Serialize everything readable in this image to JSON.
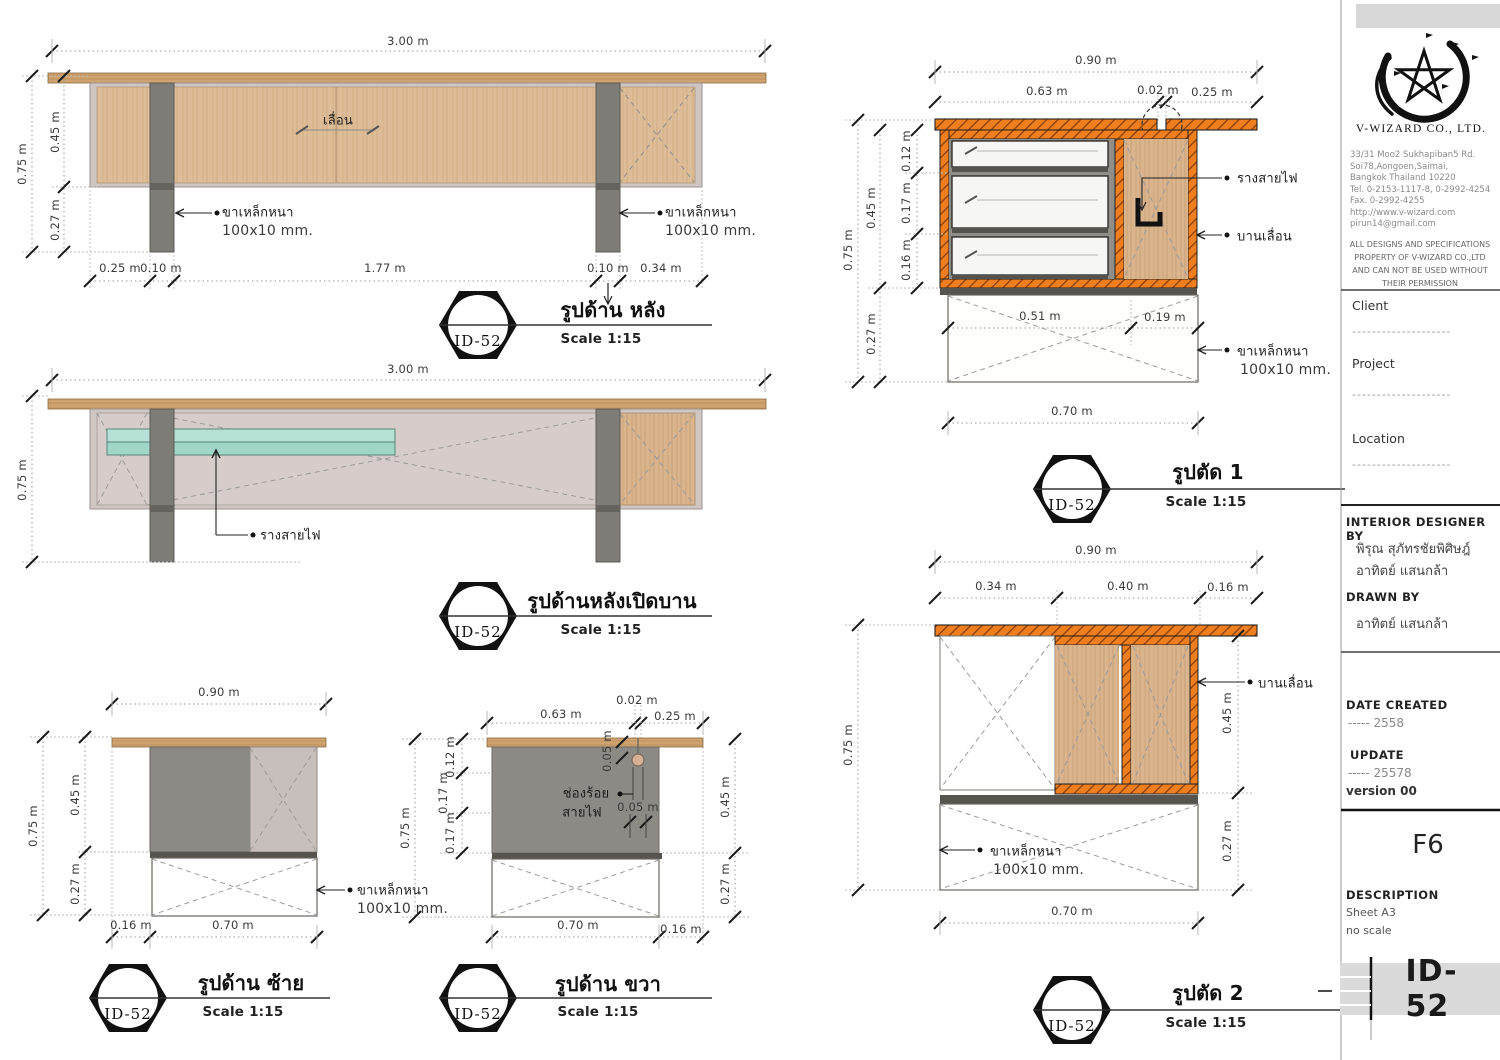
{
  "colors": {
    "section_orange": "#EF7E1F",
    "wood_grain": "#D9B48C",
    "tabletop_wood": "#CFA36F",
    "carcass_gray": "#8B8A84",
    "raceway_teal": "#9FD6C8",
    "leg_gray": "#7D7C77"
  },
  "views": {
    "rear": {
      "badge": "ID-52",
      "title": "รูปด้าน หลัง",
      "scale": "Scale 1:15",
      "dim_top": "3.00 m",
      "dim_left_total": "0.75 m",
      "dim_left_upper": "0.45 m",
      "dim_left_lower": "0.27 m",
      "dims_bottom": [
        "0.25 m",
        "0.10 m",
        "1.77 m",
        "0.10 m",
        "0.34 m"
      ],
      "label_slide": "เลื่อน",
      "leg_note_line1": "ขาเหล็กหนา",
      "leg_note_line2": "100x10 mm."
    },
    "rear_open": {
      "badge": "ID-52",
      "title": "รูปด้านหลังเปิดบาน",
      "scale": "Scale 1:15",
      "dim_top": "3.00 m",
      "dim_left_total": "0.75 m",
      "label_raceway": "รางสายไฟ"
    },
    "left_view": {
      "badge": "ID-52",
      "title": "รูปด้าน ซ้าย",
      "scale": "Scale 1:15",
      "dim_top": "0.90 m",
      "dim_left_total": "0.75 m",
      "dim_left_upper": "0.45 m",
      "dim_left_lower": "0.27 m",
      "dims_bottom": [
        "0.16 m",
        "0.70 m"
      ],
      "leg_note_line1": "ขาเหล็กหนา",
      "leg_note_line2": "100x10 mm."
    },
    "right_view": {
      "badge": "ID-52",
      "title": "รูปด้าน ขวา",
      "scale": "Scale 1:15",
      "dims_top": [
        "0.63 m",
        "0.02 m",
        "0.25 m"
      ],
      "dim_left_total": "0.75 m",
      "dims_left_stack": [
        "0.12 m",
        "0.17 m",
        "0.17 m"
      ],
      "dims_right": [
        "0.45 m",
        "0.27 m"
      ],
      "dims_bottom": [
        "0.70 m",
        "0.16 m"
      ],
      "hole_note_line1": "ช่องร้อย",
      "hole_note_line2": "สายไฟ",
      "dim_hole_top": "0.05 m",
      "dim_hole_side": "0.05 m"
    },
    "section1": {
      "badge": "ID-52",
      "title": "รูปตัด 1",
      "scale": "Scale 1:15",
      "dim_top": "0.90 m",
      "dims_top2": [
        "0.63 m",
        "0.02 m",
        "0.25 m"
      ],
      "dim_left_total": "0.75 m",
      "dim_left_upper": "0.45 m",
      "dim_left_lower": "0.27 m",
      "dims_left_stack": [
        "0.12 m",
        "0.17 m",
        "0.16 m"
      ],
      "dims_inner": [
        "0.51 m",
        "0.19 m"
      ],
      "dim_bottom": "0.70 m",
      "label_raceway": "รางสายไฟ",
      "label_sliding": "บานเลื่อน",
      "leg_note_line1": "ขาเหล็กหนา",
      "leg_note_line2": "100x10 mm."
    },
    "section2": {
      "badge": "ID-52",
      "title": "รูปตัด 2",
      "scale": "Scale 1:15",
      "dim_top": "0.90 m",
      "dims_top2": [
        "0.34 m",
        "0.40 m",
        "0.16 m"
      ],
      "dim_left_total": "0.75 m",
      "dims_right": [
        "0.45 m",
        "0.27 m"
      ],
      "dim_bottom": "0.70 m",
      "label_sliding": "บานเลื่อน",
      "leg_note_line1": "ขาเหล็กหนา",
      "leg_note_line2": "100x10 mm."
    }
  },
  "titleblock": {
    "company": "V-WIZARD CO., LTD.",
    "address": [
      "33/31 Moo2 Sukhapiban5 Rd.",
      "Soi78,Aongoen,Saimai,",
      "Bangkok Thailand 10220",
      "Tel. 0-2153-1117-8, 0-2992-4254",
      "Fax. 0-2992-4255",
      "http://www.v-wizard.com",
      "pirun14@gmail.com"
    ],
    "disclaimer": [
      "ALL DESIGNS AND SPECIFICATIONS",
      "PROPERTY OF V-WIZARD  CO.,LTD",
      "AND CAN NOT BE USED WITHOUT",
      "THEIR PERMISSION"
    ],
    "client_label": "Client",
    "project_label": "Project",
    "location_label": "Location",
    "placeholder_dashes": "--------------------",
    "designer_label": "INTERIOR DESIGNER BY",
    "designers": [
      "พิรุณ สุภัทรชัยพิศิษฎ์",
      "อาทิตย์ แสนกล้า"
    ],
    "drawn_label": "DRAWN BY",
    "drawn_by": "อาทิตย์ แสนกล้า",
    "date_label": "DATE CREATED",
    "date_value": "-----  2558",
    "update_label": "UPDATE",
    "update_value": "-----  25578",
    "version": "version 00",
    "sheet_code": "F6",
    "description_label": "DESCRIPTION",
    "description_line1": "Sheet  A3",
    "description_line2": "no scale",
    "sheet_id": "ID-52"
  }
}
